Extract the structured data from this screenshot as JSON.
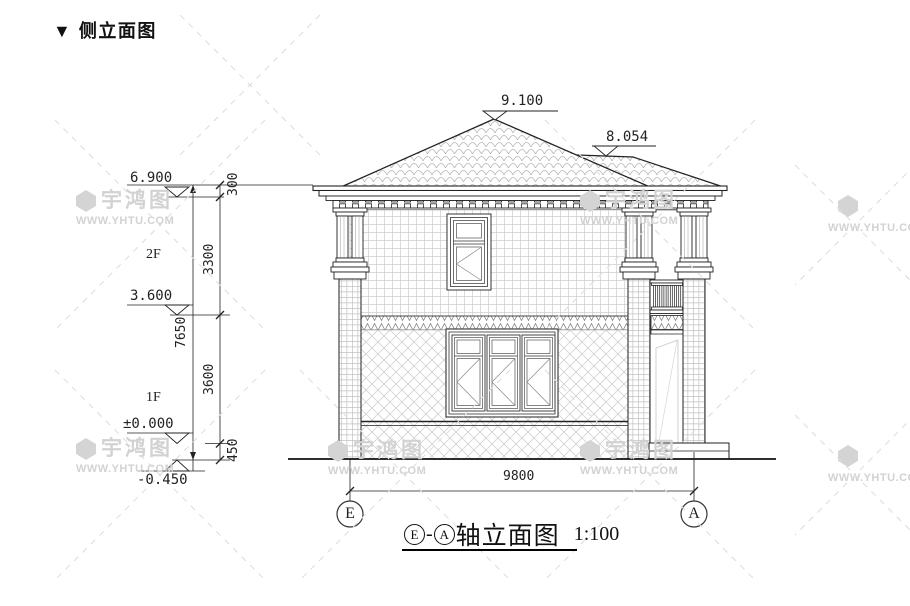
{
  "page_title": "▼ 侧立面图",
  "watermark": {
    "name": "宇鸿图",
    "url": "WWW.YHTU.COM"
  },
  "drawing": {
    "elevations": {
      "roof_peak": "9.100",
      "secondary_roof": "8.054",
      "eave": "6.900",
      "second_floor": "3.600",
      "first_floor": "±0.000",
      "ground": "-0.450"
    },
    "dimensions": {
      "parapet": "300",
      "floor2_height": "3300",
      "floor1_height": "3600",
      "plinth": "450",
      "total_height": "7650",
      "total_width": "9800"
    },
    "floor_labels": {
      "second": "2F",
      "first": "1F"
    },
    "axes": {
      "left": "E",
      "right": "A"
    },
    "caption": {
      "axis_left": "E",
      "separator": "-",
      "axis_right": "A",
      "title": "轴立面图",
      "scale": "1:100"
    }
  }
}
